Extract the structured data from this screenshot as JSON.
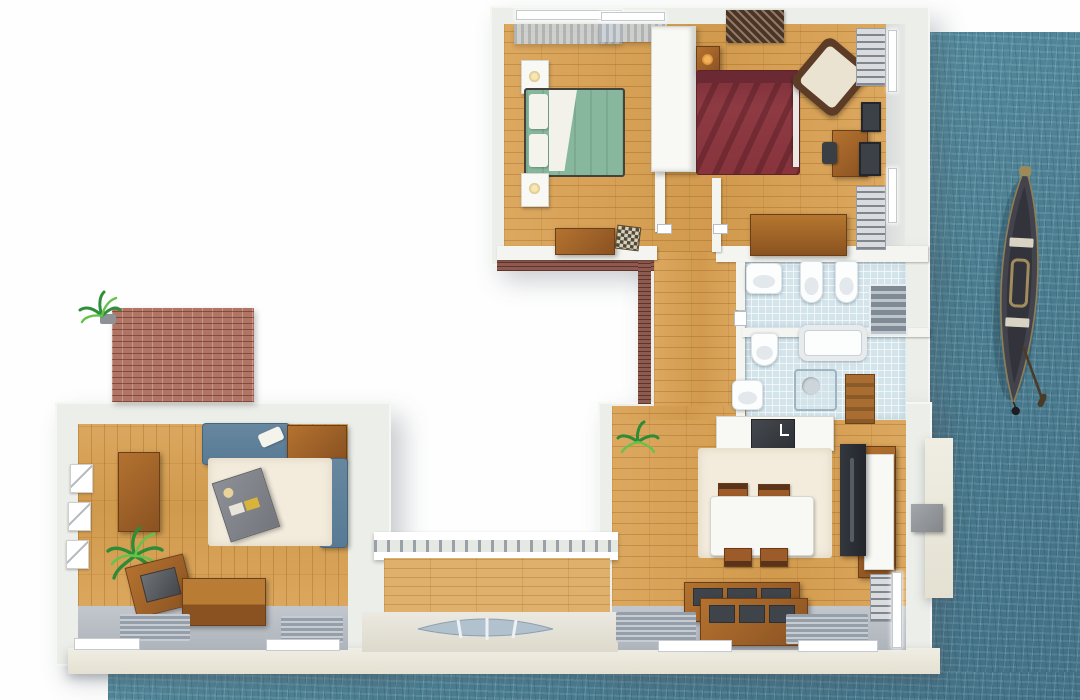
{
  "scene": {
    "title": "Aerial 3D floor plan of a waterfront apartment",
    "setting": "Apartment building seen from above, bordered by sea water on the right and bottom, with a wooden gondola moored beside it",
    "view": "top-down 3D render",
    "visible_text": ""
  },
  "palette": {
    "background": "#fefefe",
    "water": "#4d8093",
    "water_highlight": "#8fb9c4",
    "wall": "#eceee9",
    "facade": "#e8e5d6",
    "wood_floor": "#d7a45c",
    "tile_floor": "#d3e4eb",
    "brick": "#b07564",
    "brick_trim": "#8d5a50",
    "bed_green": "#87b79d",
    "bed_red": "#8e3a43",
    "sofa_blue": "#5f819b",
    "furniture_wood": "#a4632d",
    "rug_cream": "#f3ecdd",
    "terrace_floor": "#b6bcc3",
    "boat_hull": "#42424c"
  },
  "rooms": {
    "bedroom1": {
      "label": "Bedroom 1 (green bed)",
      "items": [
        "two windows with curtains",
        "white nightstand with lamp",
        "double bed with green duvet and white pillows",
        "second white nightstand",
        "wooden desk",
        "checkered stool",
        "white wardrobe divider"
      ]
    },
    "bedroom2": {
      "label": "Bedroom 2 (red bed)",
      "items": [
        "dark patterned rug",
        "wooden nightstand with lamp",
        "double bed with dark red duvet",
        "rotated armchair with cream cushion",
        "wooden desk with chair",
        "wooden dresser",
        "wall shelves",
        "two framed pictures",
        "wall windows"
      ]
    },
    "bathroom1": {
      "label": "Main bathroom",
      "items": [
        "washbasin",
        "toilet",
        "bidet",
        "grey shower stall"
      ],
      "floor": "light blue tiles"
    },
    "bathroom2": {
      "label": "Second bathroom",
      "items": [
        "bidet",
        "bathtub",
        "washbasin",
        "glass shower",
        "wooden ladder shelf"
      ],
      "floor": "light blue tiles"
    },
    "hallway": {
      "label": "Hallway",
      "items": [
        "wood plank floor",
        "door thresholds"
      ]
    },
    "living": {
      "label": "Living room",
      "items": [
        "three framed sketches",
        "tall wooden sideboard",
        "houseplant",
        "record chest",
        "wooden storage chest",
        "blue sofa with white pillow",
        "wooden corner table",
        "blue chaise seat",
        "cream area rug",
        "grey coffee table with magazines",
        "two doormats",
        "window sills"
      ]
    },
    "kitchen": {
      "label": "Kitchen / dining room",
      "items": [
        "houseplant",
        "white counter with dark cooktop",
        "cream area rug",
        "white dining table",
        "four wooden chairs",
        "dark media cabinet with wooden frame",
        "two wooden sideboards with dark trays",
        "doormats",
        "window sills",
        "wall radiator"
      ]
    },
    "balcony": {
      "label": "Terrace deck",
      "items": [
        "slatted railing",
        "wood decking",
        "curved facade vent"
      ]
    },
    "terrace_wall": {
      "label": "Brick privacy wall",
      "items": [
        "red brick wall",
        "potted plant"
      ]
    }
  },
  "exterior": {
    "water_label": "sea water",
    "boat_label": "wooden gondola with oar and mooring buoy",
    "pier_label": "grey mooring block",
    "facade_label": "cream outer wall"
  }
}
